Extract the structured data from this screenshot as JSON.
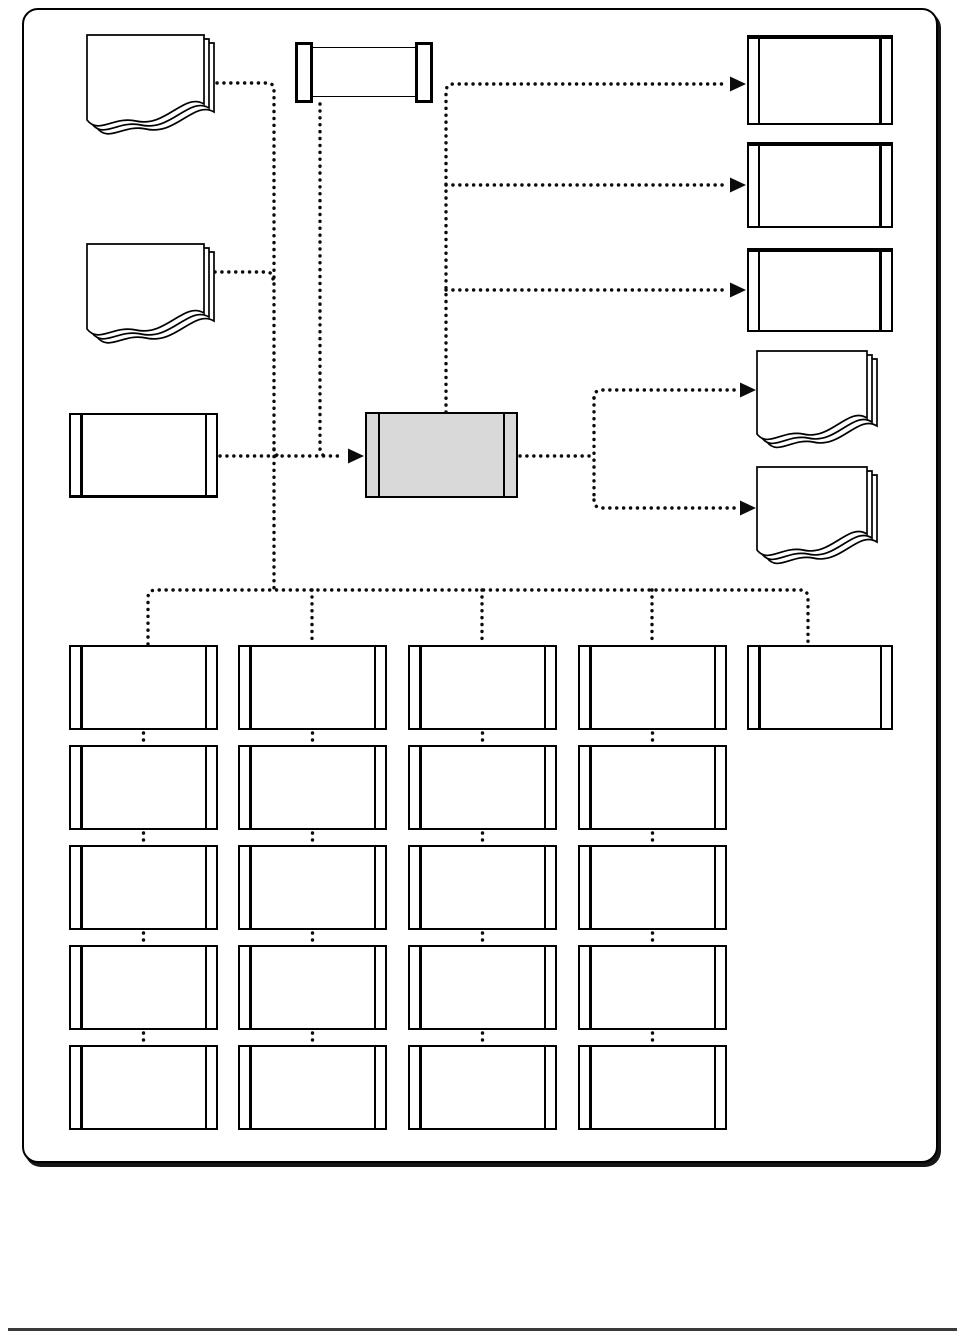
{
  "page": {
    "background_color": "#ffffff",
    "footer_rule_color": "#3a3a3a"
  },
  "diagram": {
    "type": "flowchart",
    "frame": {
      "border_color": "#000000",
      "fill": "#ffffff",
      "corner_radius_px": 16
    },
    "colors": {
      "connector": "#0b0b0b",
      "shape_outline": "#000000",
      "shape_fill": "#ffffff",
      "process_fill": "#d9d9d9"
    },
    "connector_style": "dotted",
    "nodes": {
      "input_document_top": {
        "shape": "multi-document",
        "label": ""
      },
      "input_document_middle": {
        "shape": "multi-document",
        "label": ""
      },
      "tape_unit": {
        "shape": "tape-cartridge",
        "label": ""
      },
      "input_process": {
        "shape": "predefined-process",
        "label": ""
      },
      "main_process": {
        "shape": "predefined-process",
        "label": "",
        "fill": "#d9d9d9"
      },
      "output_box_1": {
        "shape": "predefined-process",
        "label": ""
      },
      "output_box_2": {
        "shape": "predefined-process",
        "label": ""
      },
      "output_box_3": {
        "shape": "predefined-process",
        "label": ""
      },
      "output_document_1": {
        "shape": "multi-document",
        "label": ""
      },
      "output_document_2": {
        "shape": "multi-document",
        "label": ""
      }
    },
    "grid": {
      "cell_shape": "predefined-process",
      "cell_label": "",
      "columns": [
        {
          "rows": 5
        },
        {
          "rows": 5
        },
        {
          "rows": 5
        },
        {
          "rows": 5
        },
        {
          "rows": 1
        }
      ]
    },
    "arrows": {
      "count": 6,
      "direction": "right",
      "fill": "#0b0b0b"
    }
  }
}
